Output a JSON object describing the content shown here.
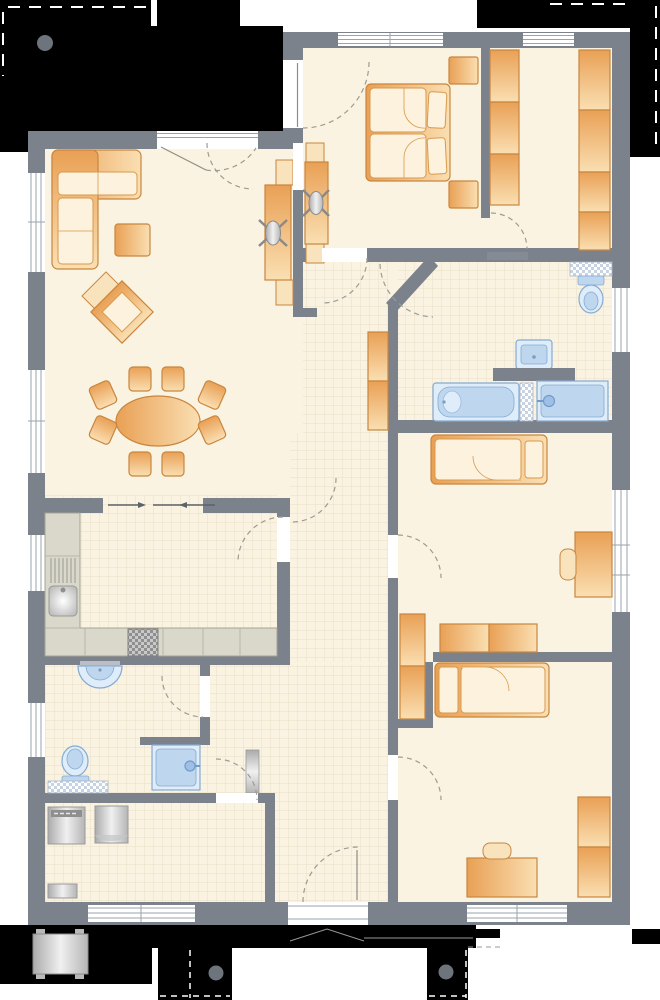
{
  "title": "house-floor-plan",
  "palette": {
    "floor": "#faf3e2",
    "wall": "#7b828c",
    "mask": "#000000",
    "furniture_edge": "#c8863e",
    "furniture_light": "#f8e3bd",
    "fabric": "#fcf2dd",
    "fixture_fill": "#dfecf9",
    "fixture_edge": "#85abd0",
    "fixture_inner": "#bed7ef",
    "counter": "#dad8ca",
    "counter_edge": "#a7a496",
    "tile_line": "#eadfc6",
    "checker": "#c7d2e2",
    "marker_dot": "#6e747c",
    "door_line": "#8d8e86",
    "door_dash": "#9c9c92",
    "window_line": "#9aa3ac"
  },
  "rooms": [
    "living-room",
    "dining-area",
    "kitchen",
    "hallway",
    "entrance-hall",
    "master-bedroom",
    "dressing-room",
    "bathroom",
    "child-room-1",
    "child-room-2",
    "guest-bathroom",
    "utility-room"
  ],
  "furniture": {
    "living": [
      "corner-sofa",
      "coffee-table",
      "armchair",
      "desk",
      "office-chair"
    ],
    "dining": [
      "oval-table"
    ],
    "dining_chair_count": 8,
    "master_bedroom": [
      "double-bed",
      "pillow",
      "pillow",
      "nightstand",
      "nightstand",
      "desk",
      "office-chair"
    ],
    "dressing": [
      "wardrobe-left",
      "wardrobe-right"
    ],
    "hall": [
      "closet",
      "radiator"
    ],
    "child_room_1": [
      "single-bed",
      "desk",
      "chair",
      "wardrobe-column",
      "wardrobe-row"
    ],
    "child_room_2": [
      "single-bed",
      "desk",
      "chair",
      "wardrobe"
    ]
  },
  "fixtures": {
    "bathroom": [
      "bathtub",
      "shower",
      "washbasin",
      "toilet"
    ],
    "guest_bathroom": [
      "washbasin",
      "toilet",
      "shower"
    ]
  },
  "appliances": [
    "kitchen-sink",
    "stove",
    "washing-machine",
    "dryer"
  ],
  "outdoor": [
    "doormat-bench",
    "entrance-gable-mark",
    "planter-dot",
    "planter-dot",
    "tree-dot",
    "boundary-dashes"
  ],
  "door_count": 13,
  "window_count": 11
}
